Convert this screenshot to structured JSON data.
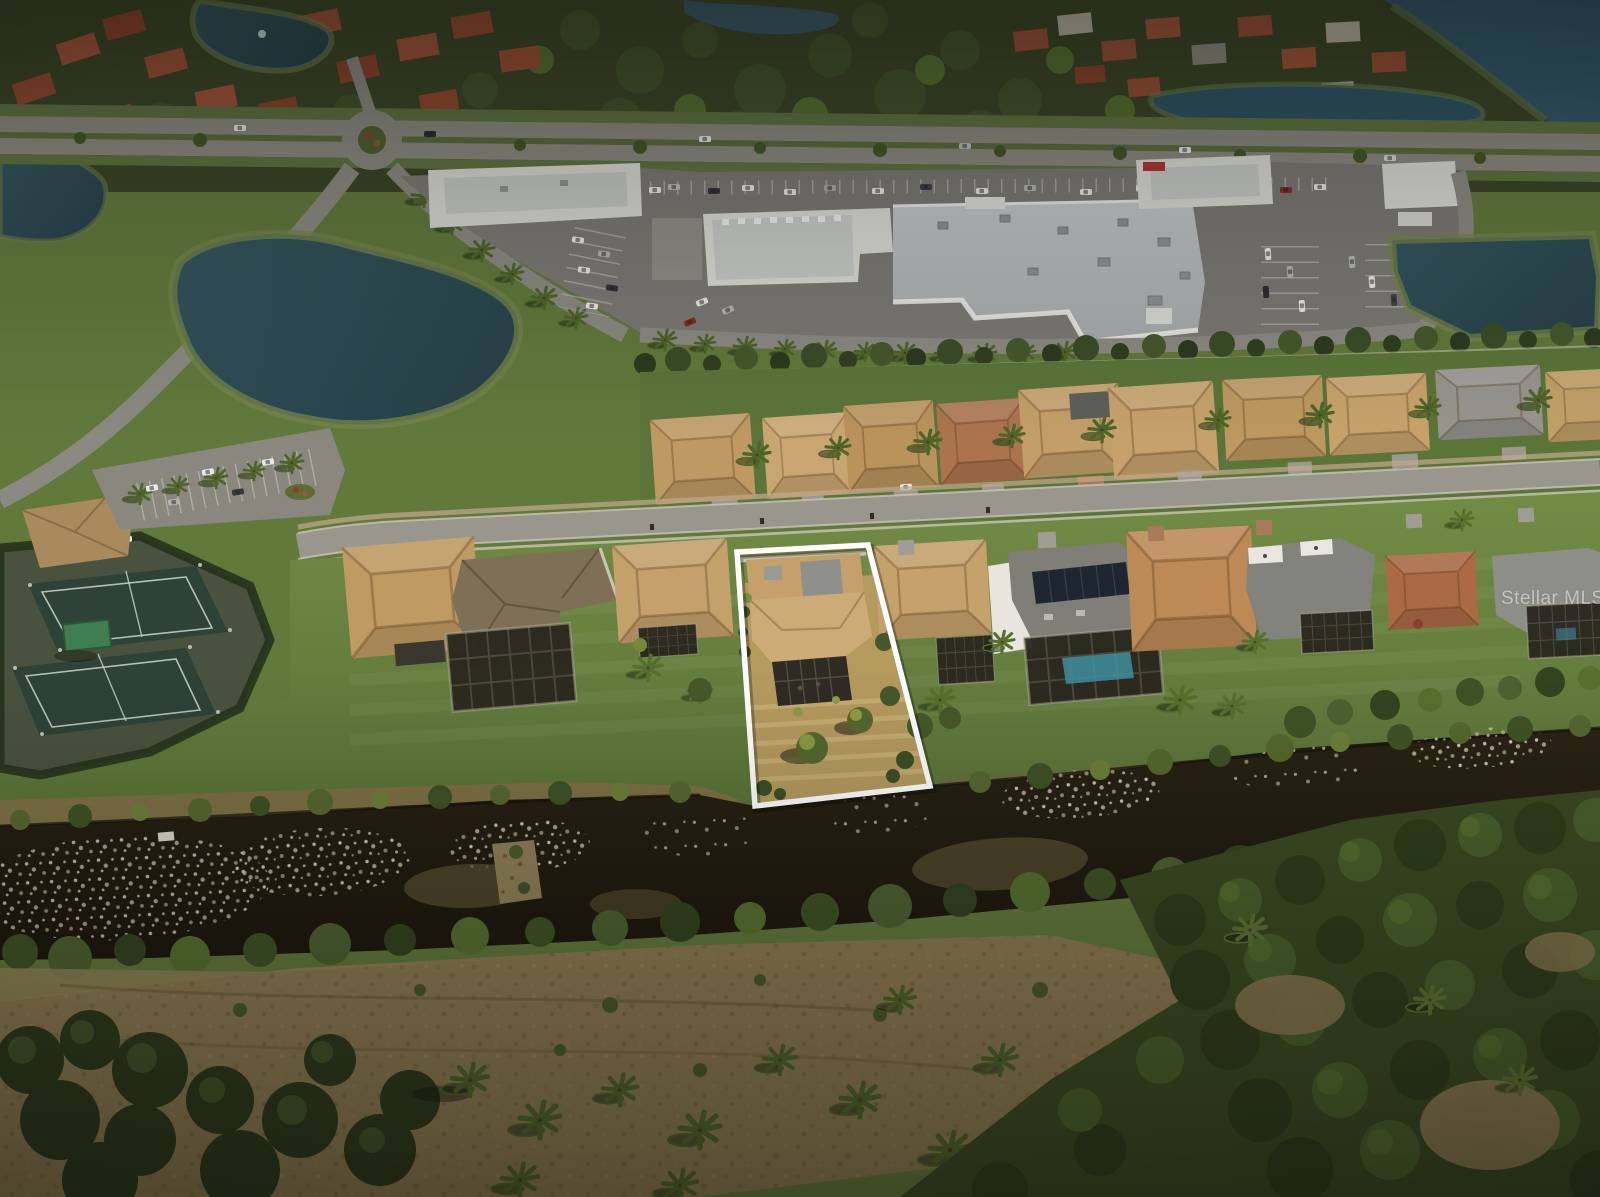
{
  "meta": {
    "kind": "aerial-drone-photograph",
    "subject": "single-family home lot highlighted with a white boundary outline, suburban Florida setting with shopping plaza, ponds, tennis courts and a canal",
    "width_px": 1600,
    "height_px": 1197
  },
  "watermark": {
    "text": "Stellar MLS"
  },
  "highlight": {
    "name": "property-boundary",
    "stroke": "#ffffff"
  },
  "palette": {
    "watermark": "rgba(255,255,255,0.52)",
    "boundary": "#ffffff",
    "lawn": "#69843f",
    "dry_lot_grass": "#b59a5e",
    "canal_water": "#221c12",
    "pond_water": "#2e4a55",
    "road": "#99968d",
    "parking_asphalt": "#7b7973",
    "big_box_roof": "#b9bcbd",
    "tile_roof_tan": "#c3a06b",
    "tile_roof_red": "#9a4f35",
    "tennis_court": "#2e4237",
    "pool": "#3f8fa0",
    "forest": "#3a4a22",
    "scrub_field": "#8d7b52"
  },
  "scene": {
    "regions": [
      {
        "id": "top-residential-neighborhood",
        "note": "red tile roofs, trees, small lakes"
      },
      {
        "id": "main-boulevard",
        "note": "divided highway with roundabout"
      },
      {
        "id": "shopping-plaza",
        "note": "big-box store, retail pads, car parking"
      },
      {
        "id": "retention-ponds",
        "note": "dark blue ponds with green banks"
      },
      {
        "id": "back-row-homes",
        "note": "tan tile roofs behind privacy wall"
      },
      {
        "id": "residential-street",
        "note": "curving street with sidewalks"
      },
      {
        "id": "front-row-homes",
        "note": "homes with screened lanais and a pool"
      },
      {
        "id": "subject-lot-highlighted",
        "note": "white outlined lot with dry lawn"
      },
      {
        "id": "tennis-courts",
        "note": "two dark green courts with shade canopy"
      },
      {
        "id": "canal-with-lily-pads",
        "note": "dark canal, lily pad patches, rock weir"
      },
      {
        "id": "scrub-field",
        "note": "brown mowed scrub south of canal"
      },
      {
        "id": "forest",
        "note": "dense tree masses bottom and right"
      }
    ]
  }
}
